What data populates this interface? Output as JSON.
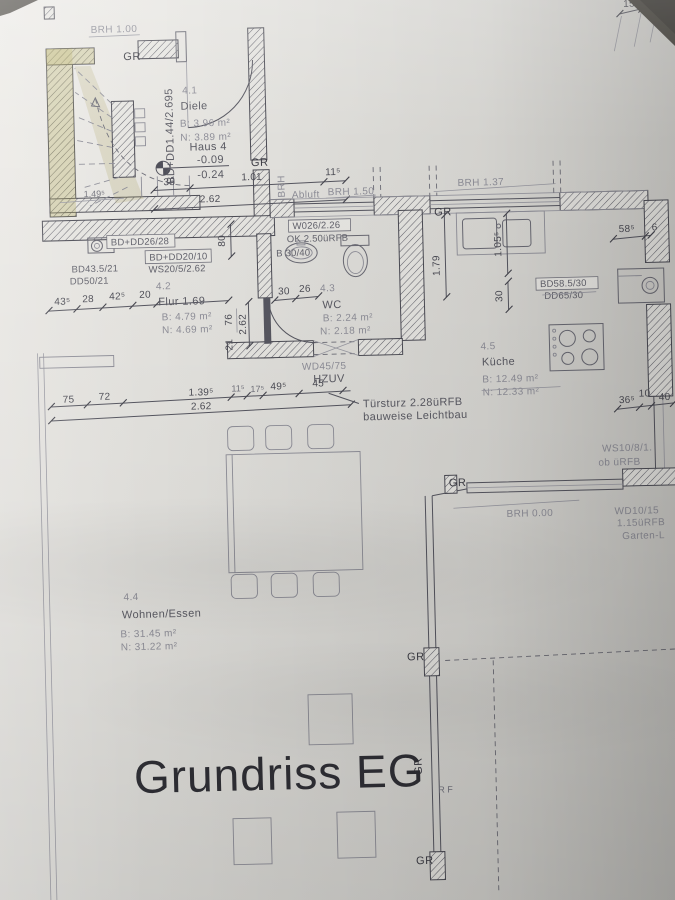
{
  "title": "Grundriss EG",
  "marker": {
    "gr": "GR",
    "rf": "R F"
  },
  "rooms": {
    "diele": {
      "number": "4.1",
      "name": "Diele",
      "area_b": "B: 3.96 m²",
      "area_n": "N: 3.89 m²"
    },
    "flur": {
      "number": "4.2",
      "name": "Flur 1.69",
      "area_b": "B: 4.79 m²",
      "area_n": "N: 4.69 m²"
    },
    "wc": {
      "number": "4.3",
      "name": "WC",
      "area_b": "B: 2.24 m²",
      "area_n": "N: 2.18 m²"
    },
    "wohnen_essen": {
      "number": "4.4",
      "name": "Wohnen/Essen",
      "area_b": "B: 31.45 m²",
      "area_n": "N: 31.22 m²"
    },
    "kueche": {
      "number": "4.5",
      "name": "Küche",
      "area_b": "B: 12.49 m²",
      "area_n": "N: 12.33 m²"
    }
  },
  "level_marker": {
    "label": "Haus 4",
    "upper": "-0.09",
    "lower": "-0.24"
  },
  "windows": {
    "brh_100": "BRH 1.00",
    "brh_150": "BRH 1.50",
    "brh_137": "BRH 1.37",
    "brh_000": "BRH 0.00",
    "abluft": "Abluft",
    "brh_side": "BRH"
  },
  "component_labels": {
    "bd_dd_26_28": "BD+DD26/28",
    "bd_dd_20_10": "BD+DD20/10",
    "ws_20_5": "WS20/5/2.62",
    "bd_43": "BD43.5/21",
    "dd_50": "DD50/21",
    "bd_dd_144": "BD+DD1.44/2.695",
    "w_026": "W026/2.26",
    "ok_250": "OK 2.50üRFB",
    "b_30_40": "B 30/40",
    "bd_58": "BD58.5/30",
    "dd_65": "DD65/30",
    "wd_45_75": "WD45/75",
    "hzuv": "HZUV",
    "ws_10_8": "WS10/8/1.",
    "ob_uerfb": "ob üRFB",
    "wd_10_15": "WD10/15",
    "uerfb_115": "1.15üRFB",
    "garten": "Garten-L"
  },
  "notes": {
    "tuersturz_line1": "Türsturz 2.28üRFB",
    "tuersturz_line2": "bauweise Leichtbau"
  },
  "dims": {
    "top": {
      "d35": "35",
      "d101": "1.01",
      "d115": "11⁵",
      "d262": "2.62",
      "d1495": "1.49⁵"
    },
    "flur_row": {
      "d435": "43⁵",
      "d28": "28",
      "d425": "42⁵",
      "d20": "20"
    },
    "wc": {
      "d30": "30",
      "d26": "26",
      "d80": "80",
      "d76": "76",
      "d262": "2.62",
      "d21": "21"
    },
    "bottom": {
      "d75": "75",
      "d72": "72",
      "d1395": "1.39⁵",
      "d115": "11⁵",
      "d175": "17⁵",
      "d495": "49⁵",
      "d45": "45",
      "d262": "2.62"
    },
    "kitchen": {
      "d585": "58⁵",
      "d6": "6",
      "d1055": "1.05⁵",
      "d179": "1.79",
      "d30": "30",
      "d365": "36⁵",
      "d10": "10",
      "d40": "40"
    },
    "top_right": {
      "d15": "15",
      "d7": "7"
    }
  }
}
